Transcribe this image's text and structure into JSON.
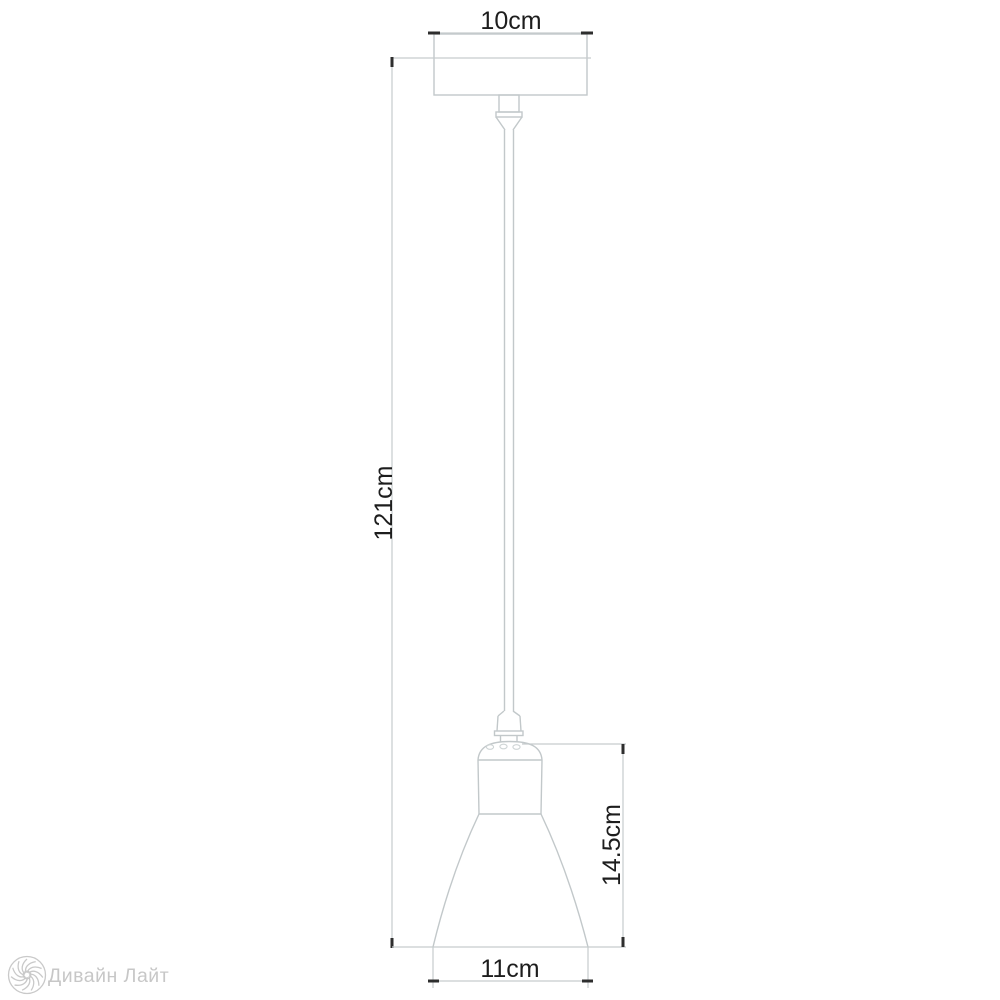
{
  "diagram": {
    "type": "technical-dimension-drawing",
    "subject": "pendant ceiling lamp with canopy, suspension cord and cone shade",
    "dimensions": {
      "canopy_width_label": "10cm",
      "overall_height_label": "121cm",
      "shade_height_label": "14.5cm",
      "shade_width_label": "11cm"
    },
    "colors": {
      "background": "#ffffff",
      "outline": "#c2c8ca",
      "dimension_line": "#c6cccd",
      "tick": "#2e2e2e",
      "label_text": "#1d1d1d",
      "watermark": "#c7c7c7"
    }
  },
  "watermark": {
    "brand_name": "Дивайн Лайт"
  }
}
